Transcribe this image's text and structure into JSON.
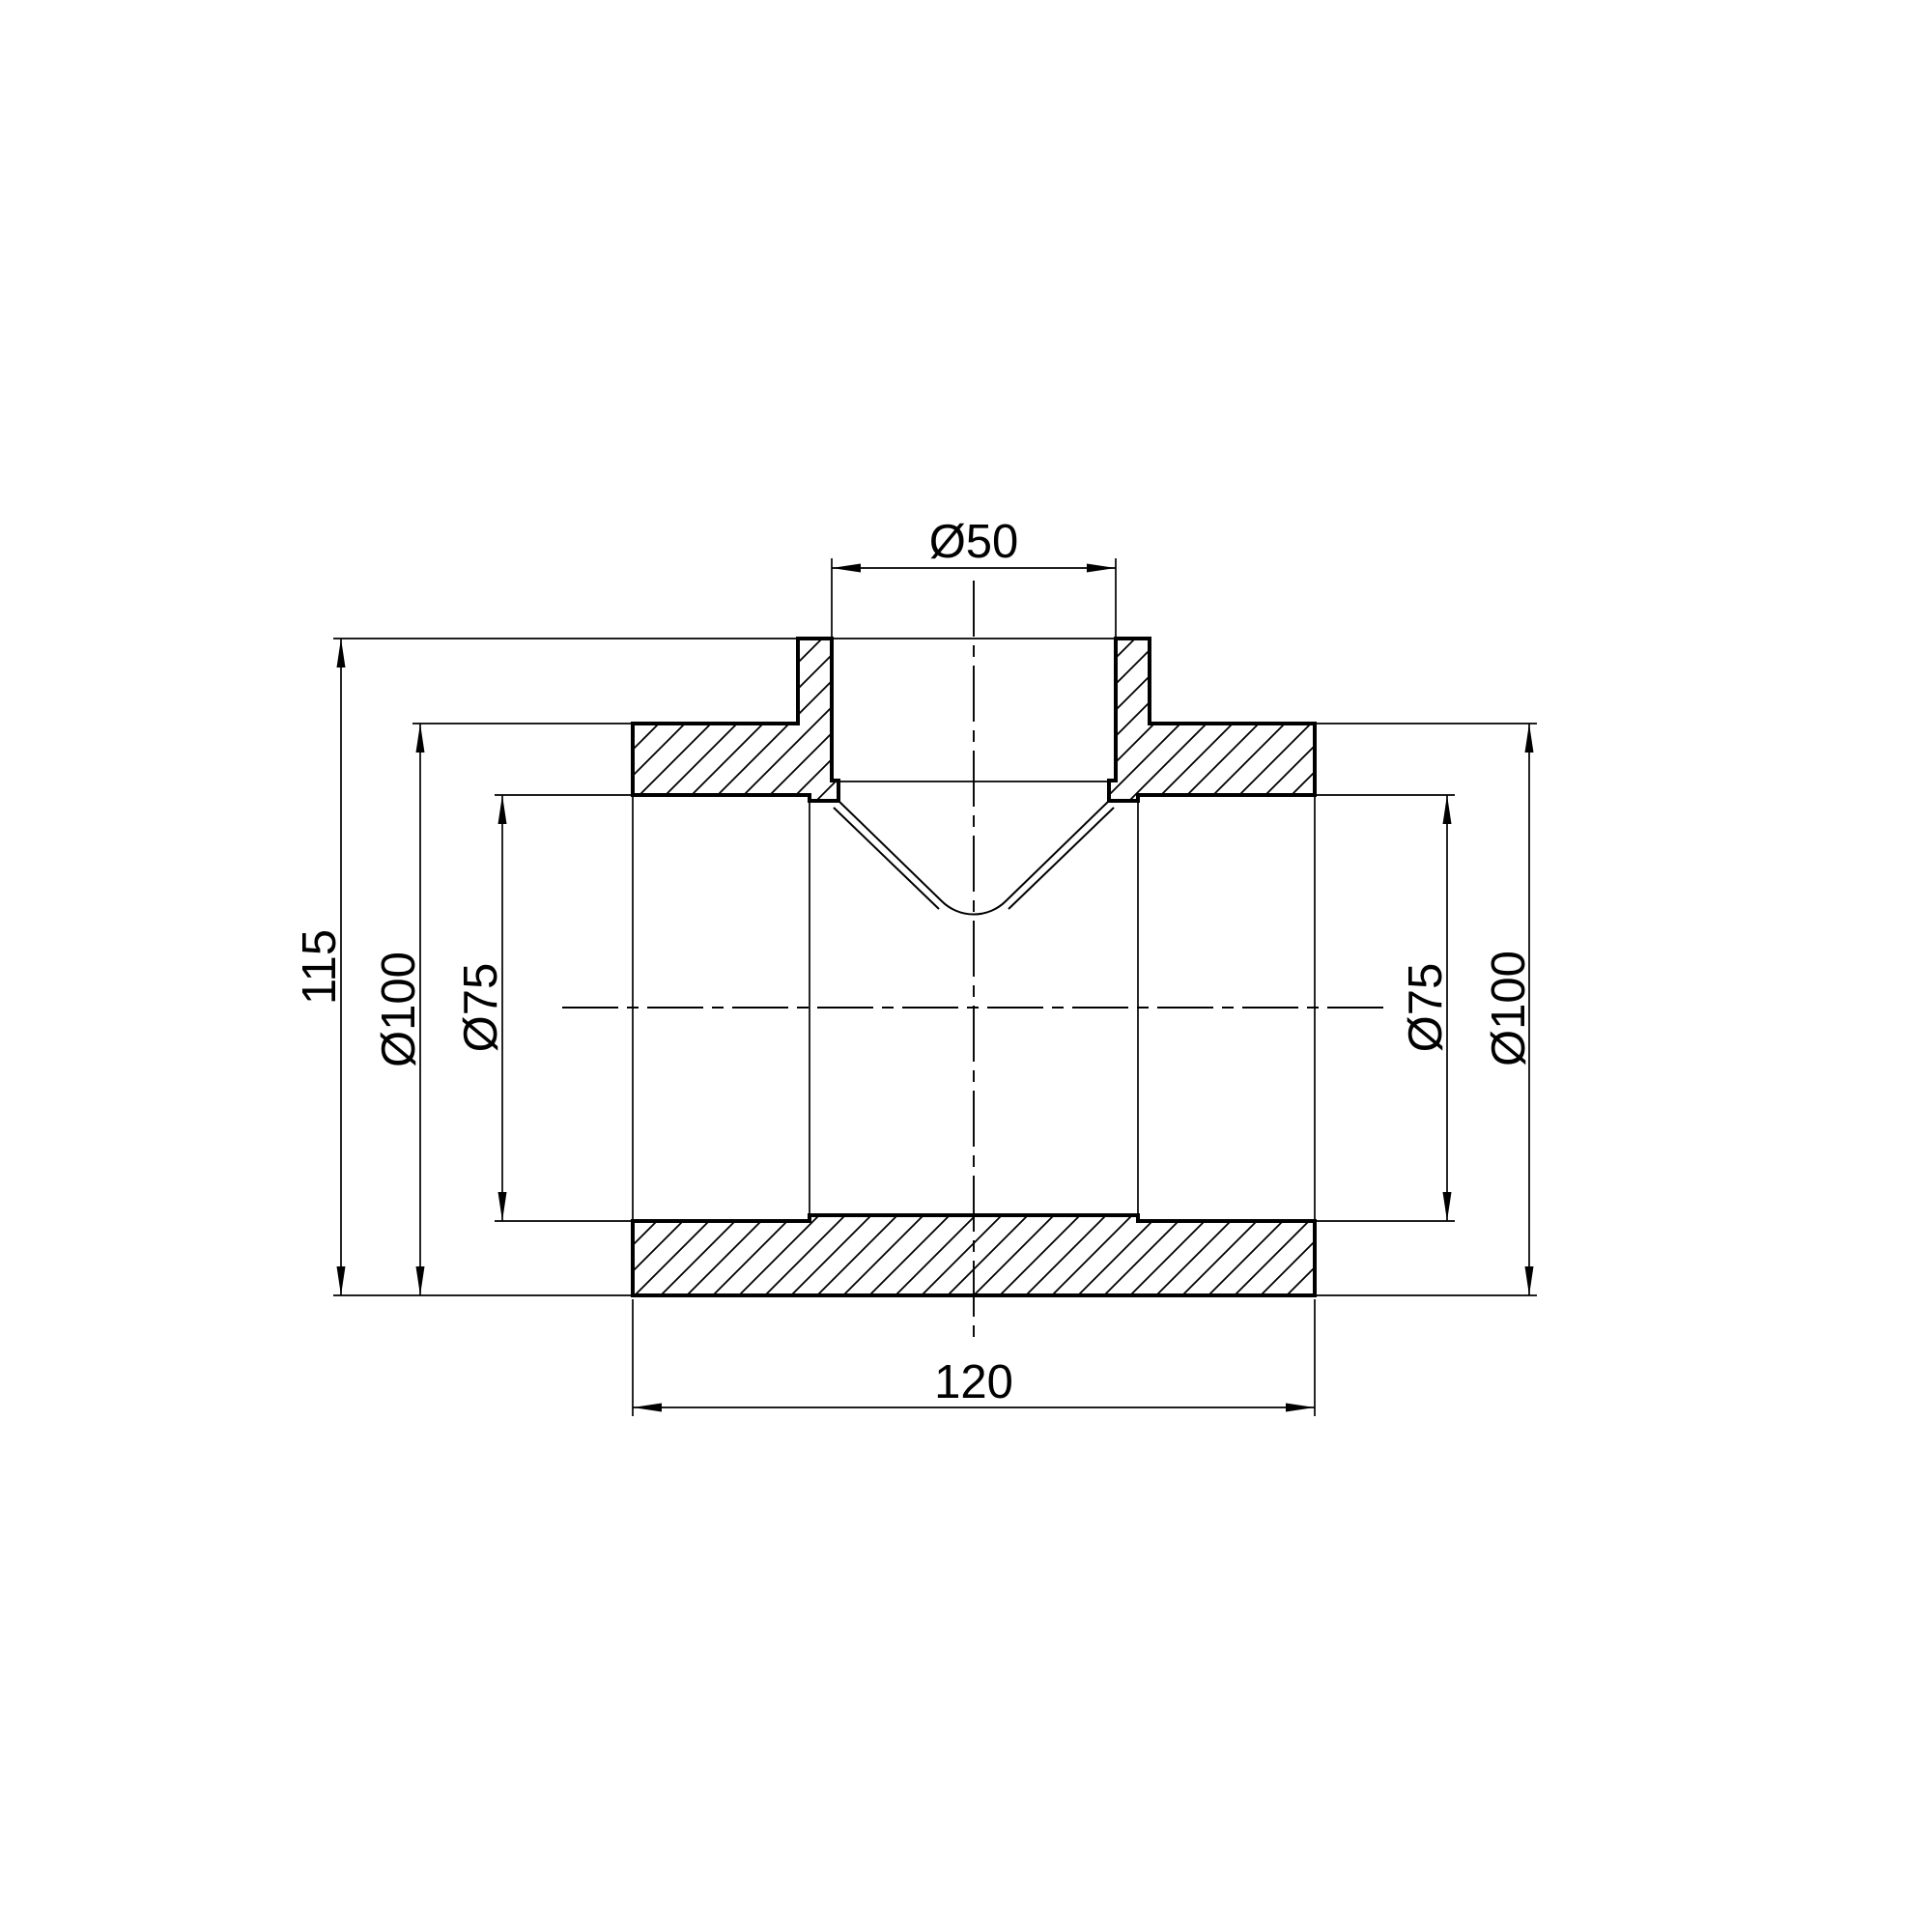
{
  "drawing": {
    "description": "Sectional engineering drawing of a PPR tee pipe fitting",
    "background_color": "#ffffff",
    "line_color": "#000000",
    "dimensions": {
      "branch_bore": {
        "label": "Ø50",
        "value": 50
      },
      "overall_height": {
        "label": "115",
        "value": 115
      },
      "outer_diameter_left": {
        "label": "Ø100",
        "value": 100
      },
      "socket_diameter_left": {
        "label": "Ø75",
        "value": 75
      },
      "socket_diameter_right": {
        "label": "Ø75",
        "value": 75
      },
      "outer_diameter_right": {
        "label": "Ø100",
        "value": 100
      },
      "overall_length": {
        "label": "120",
        "value": 120
      }
    }
  }
}
